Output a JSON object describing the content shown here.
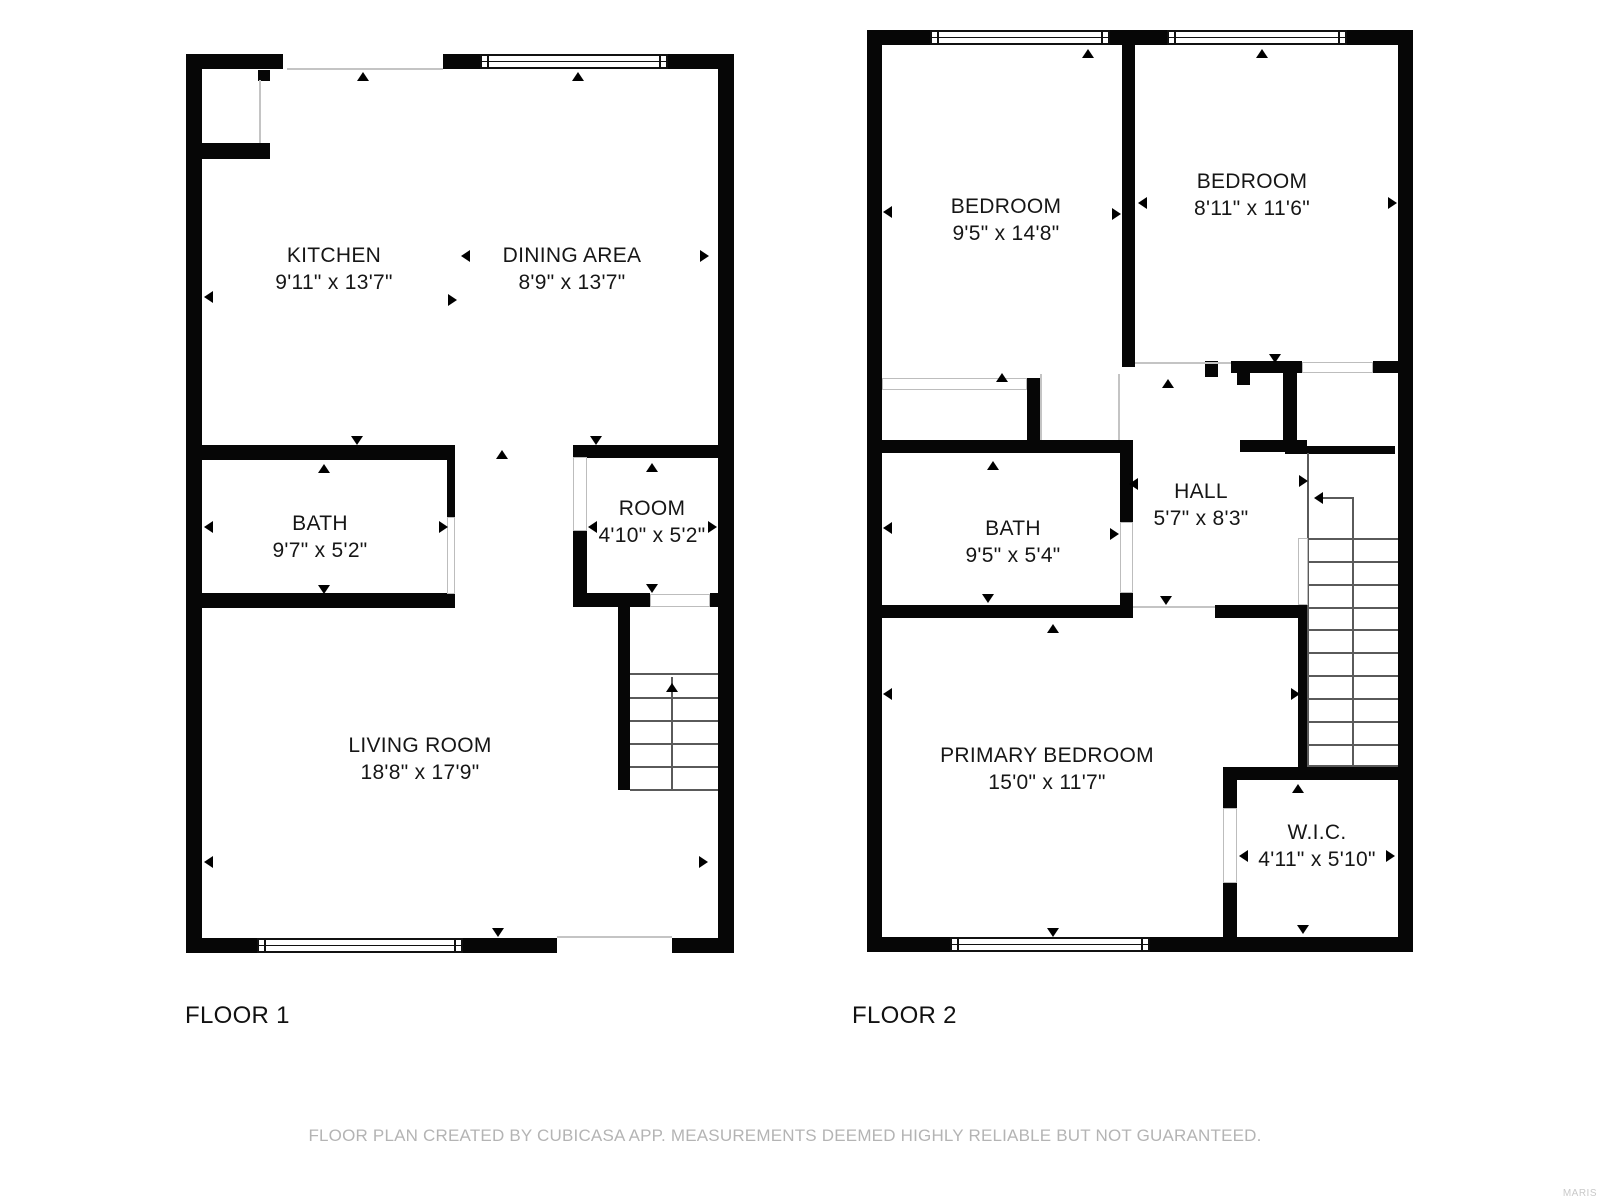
{
  "footer": {
    "disclaimer": "FLOOR PLAN CREATED BY CUBICASA APP. MEASUREMENTS DEEMED HIGHLY RELIABLE BUT NOT GUARANTEED.",
    "watermark": "MARIS"
  },
  "colors": {
    "wall": "#060606",
    "opening_line": "#c4c4c4",
    "stair_line": "#5a5a5a",
    "label_text": "#161616",
    "muted_text": "#b4b4b4"
  },
  "floors": [
    {
      "label": "FLOOR 1",
      "rooms": [
        {
          "name": "KITCHEN",
          "dims": "9'11\" x 13'7\"",
          "cx": 334,
          "cy": 269
        },
        {
          "name": "DINING AREA",
          "dims": "8'9\" x 13'7\"",
          "cx": 572,
          "cy": 269
        },
        {
          "name": "BATH",
          "dims": "9'7\" x 5'2\"",
          "cx": 320,
          "cy": 537
        },
        {
          "name": "ROOM",
          "dims": "4'10\" x 5'2\"",
          "cx": 652,
          "cy": 522
        },
        {
          "name": "LIVING ROOM",
          "dims": "18'8\" x 17'9\"",
          "cx": 420,
          "cy": 759
        }
      ],
      "walls": [
        [
          186,
          54,
          16,
          899
        ],
        [
          186,
          54,
          97,
          15
        ],
        [
          443,
          54,
          37,
          15
        ],
        [
          668,
          54,
          66,
          15
        ],
        [
          718,
          54,
          16,
          899
        ],
        [
          186,
          938,
          71,
          15
        ],
        [
          463,
          938,
          94,
          15
        ],
        [
          672,
          938,
          62,
          15
        ],
        [
          258,
          70,
          12,
          11
        ],
        [
          202,
          143,
          68,
          16
        ],
        [
          186,
          445,
          269,
          15
        ],
        [
          447,
          460,
          8,
          57
        ],
        [
          186,
          593,
          269,
          15
        ],
        [
          573,
          445,
          161,
          13
        ],
        [
          573,
          530,
          14,
          77
        ],
        [
          573,
          593,
          77,
          14
        ],
        [
          710,
          593,
          24,
          14
        ],
        [
          618,
          607,
          12,
          183
        ]
      ],
      "windows": [
        [
          480,
          54,
          188,
          15
        ],
        [
          257,
          938,
          206,
          15
        ]
      ],
      "openings": [
        [
          447,
          517,
          8,
          77
        ],
        [
          573,
          457,
          14,
          74
        ],
        [
          650,
          594,
          60,
          13
        ]
      ],
      "lines": [
        [
          287,
          68,
          156,
          2
        ],
        [
          557,
          936,
          115,
          2
        ],
        [
          259,
          80,
          2,
          63
        ]
      ],
      "slines": [
        [
          630,
          673,
          88,
          2
        ],
        [
          630,
          697,
          88,
          2
        ],
        [
          630,
          720,
          88,
          2
        ],
        [
          630,
          743,
          88,
          2
        ],
        [
          630,
          766,
          88,
          2
        ],
        [
          630,
          789,
          88,
          2
        ],
        [
          671,
          677,
          2,
          112
        ]
      ],
      "arrows": [
        {
          "x": 363,
          "y": 73,
          "d": "up"
        },
        {
          "x": 578,
          "y": 73,
          "d": "up"
        },
        {
          "x": 205,
          "y": 297,
          "d": "left"
        },
        {
          "x": 462,
          "y": 256,
          "d": "left"
        },
        {
          "x": 452,
          "y": 300,
          "d": "right"
        },
        {
          "x": 704,
          "y": 256,
          "d": "right"
        },
        {
          "x": 357,
          "y": 440,
          "d": "down"
        },
        {
          "x": 324,
          "y": 465,
          "d": "up"
        },
        {
          "x": 502,
          "y": 451,
          "d": "up"
        },
        {
          "x": 596,
          "y": 440,
          "d": "down"
        },
        {
          "x": 652,
          "y": 464,
          "d": "up"
        },
        {
          "x": 589,
          "y": 527,
          "d": "left"
        },
        {
          "x": 712,
          "y": 527,
          "d": "right"
        },
        {
          "x": 652,
          "y": 588,
          "d": "down"
        },
        {
          "x": 205,
          "y": 527,
          "d": "left"
        },
        {
          "x": 443,
          "y": 527,
          "d": "right"
        },
        {
          "x": 324,
          "y": 589,
          "d": "down"
        },
        {
          "x": 205,
          "y": 862,
          "d": "left"
        },
        {
          "x": 703,
          "y": 862,
          "d": "right"
        },
        {
          "x": 498,
          "y": 932,
          "d": "down"
        },
        {
          "x": 672,
          "y": 684,
          "d": "up"
        }
      ]
    },
    {
      "label": "FLOOR 2",
      "rooms": [
        {
          "name": "BEDROOM",
          "dims": "9'5\" x 14'8\"",
          "cx": 1006,
          "cy": 220
        },
        {
          "name": "BEDROOM",
          "dims": "8'11\" x 11'6\"",
          "cx": 1252,
          "cy": 195
        },
        {
          "name": "BATH",
          "dims": "9'5\" x 5'4\"",
          "cx": 1013,
          "cy": 542
        },
        {
          "name": "HALL",
          "dims": "5'7\" x 8'3\"",
          "cx": 1201,
          "cy": 505
        },
        {
          "name": "PRIMARY BEDROOM",
          "dims": "15'0\" x 11'7\"",
          "cx": 1047,
          "cy": 769
        },
        {
          "name": "W.I.C.",
          "dims": "4'11\" x 5'10\"",
          "cx": 1317,
          "cy": 846
        }
      ],
      "walls": [
        [
          867,
          30,
          15,
          922
        ],
        [
          867,
          30,
          63,
          15
        ],
        [
          1110,
          30,
          57,
          15
        ],
        [
          1347,
          30,
          66,
          15
        ],
        [
          1398,
          30,
          15,
          922
        ],
        [
          867,
          937,
          83,
          15
        ],
        [
          1150,
          937,
          263,
          15
        ],
        [
          1122,
          45,
          13,
          322
        ],
        [
          1027,
          378,
          13,
          62
        ],
        [
          867,
          440,
          266,
          13
        ],
        [
          1120,
          453,
          13,
          69
        ],
        [
          1120,
          593,
          13,
          25
        ],
        [
          867,
          605,
          253,
          13
        ],
        [
          1215,
          605,
          93,
          13
        ],
        [
          1205,
          361,
          13,
          16
        ],
        [
          1231,
          361,
          71,
          12
        ],
        [
          1237,
          373,
          13,
          12
        ],
        [
          1283,
          373,
          14,
          77
        ],
        [
          1240,
          440,
          67,
          12
        ],
        [
          1373,
          361,
          25,
          12
        ],
        [
          1285,
          446,
          110,
          8
        ],
        [
          1298,
          607,
          10,
          160
        ],
        [
          1223,
          767,
          175,
          13
        ],
        [
          1223,
          767,
          14,
          41
        ],
        [
          1223,
          883,
          14,
          69
        ]
      ],
      "windows": [
        [
          930,
          30,
          180,
          15
        ],
        [
          1167,
          30,
          180,
          15
        ],
        [
          950,
          937,
          200,
          15
        ]
      ],
      "openings": [
        [
          882,
          378,
          145,
          12
        ],
        [
          1302,
          362,
          71,
          11
        ],
        [
          1120,
          522,
          13,
          71
        ],
        [
          1223,
          808,
          14,
          75
        ],
        [
          1298,
          538,
          10,
          67
        ]
      ],
      "lines": [
        [
          1135,
          362,
          96,
          2
        ],
        [
          1040,
          374,
          2,
          66
        ],
        [
          1118,
          374,
          2,
          66
        ],
        [
          1133,
          606,
          82,
          2
        ]
      ],
      "slines": [
        [
          1307,
          453,
          2,
          312
        ],
        [
          1307,
          538,
          91,
          2
        ],
        [
          1307,
          561,
          91,
          2
        ],
        [
          1307,
          584,
          91,
          2
        ],
        [
          1307,
          607,
          91,
          2
        ],
        [
          1307,
          629,
          91,
          2
        ],
        [
          1307,
          652,
          91,
          2
        ],
        [
          1307,
          675,
          91,
          2
        ],
        [
          1307,
          698,
          91,
          2
        ],
        [
          1307,
          721,
          91,
          2
        ],
        [
          1307,
          744,
          91,
          2
        ],
        [
          1307,
          765,
          91,
          2
        ],
        [
          1352,
          497,
          2,
          268
        ],
        [
          1317,
          497,
          36,
          2
        ]
      ],
      "arrows": [
        {
          "x": 1088,
          "y": 50,
          "d": "up"
        },
        {
          "x": 1262,
          "y": 50,
          "d": "up"
        },
        {
          "x": 884,
          "y": 212,
          "d": "left"
        },
        {
          "x": 1116,
          "y": 214,
          "d": "right"
        },
        {
          "x": 1139,
          "y": 203,
          "d": "left"
        },
        {
          "x": 1392,
          "y": 203,
          "d": "right"
        },
        {
          "x": 1002,
          "y": 374,
          "d": "up"
        },
        {
          "x": 1168,
          "y": 380,
          "d": "up"
        },
        {
          "x": 1275,
          "y": 358,
          "d": "down"
        },
        {
          "x": 993,
          "y": 462,
          "d": "up"
        },
        {
          "x": 988,
          "y": 598,
          "d": "down"
        },
        {
          "x": 884,
          "y": 528,
          "d": "left"
        },
        {
          "x": 1114,
          "y": 534,
          "d": "right"
        },
        {
          "x": 1130,
          "y": 484,
          "d": "left"
        },
        {
          "x": 1303,
          "y": 481,
          "d": "right"
        },
        {
          "x": 1166,
          "y": 600,
          "d": "down"
        },
        {
          "x": 1053,
          "y": 625,
          "d": "up"
        },
        {
          "x": 884,
          "y": 694,
          "d": "left"
        },
        {
          "x": 1295,
          "y": 694,
          "d": "right"
        },
        {
          "x": 1053,
          "y": 932,
          "d": "down"
        },
        {
          "x": 1298,
          "y": 785,
          "d": "up"
        },
        {
          "x": 1303,
          "y": 929,
          "d": "down"
        },
        {
          "x": 1240,
          "y": 856,
          "d": "left"
        },
        {
          "x": 1390,
          "y": 856,
          "d": "right"
        },
        {
          "x": 1315,
          "y": 498,
          "d": "left"
        }
      ]
    }
  ]
}
